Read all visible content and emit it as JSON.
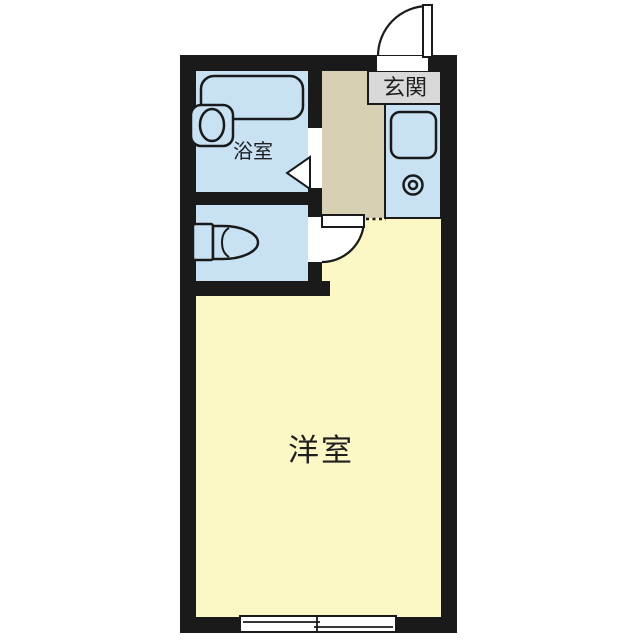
{
  "floorplan": {
    "rooms": {
      "genkan_label": "玄関",
      "bathroom_label": "浴室",
      "main_room_label": "洋室"
    },
    "fixtures": [
      "bathtub",
      "washbasin",
      "toilet",
      "kitchen-sink",
      "stove-burner",
      "entrance-door-swing",
      "room-door-swing",
      "bathroom-folding-door",
      "sliding-window"
    ],
    "colors": {
      "wall": "#1a1a1a",
      "wet_room": "#c8e2f4",
      "hallway": "#d8d0b2",
      "main_room": "#fcf8c6",
      "label_box": "#d9d9d9",
      "background": "#ffffff"
    }
  }
}
